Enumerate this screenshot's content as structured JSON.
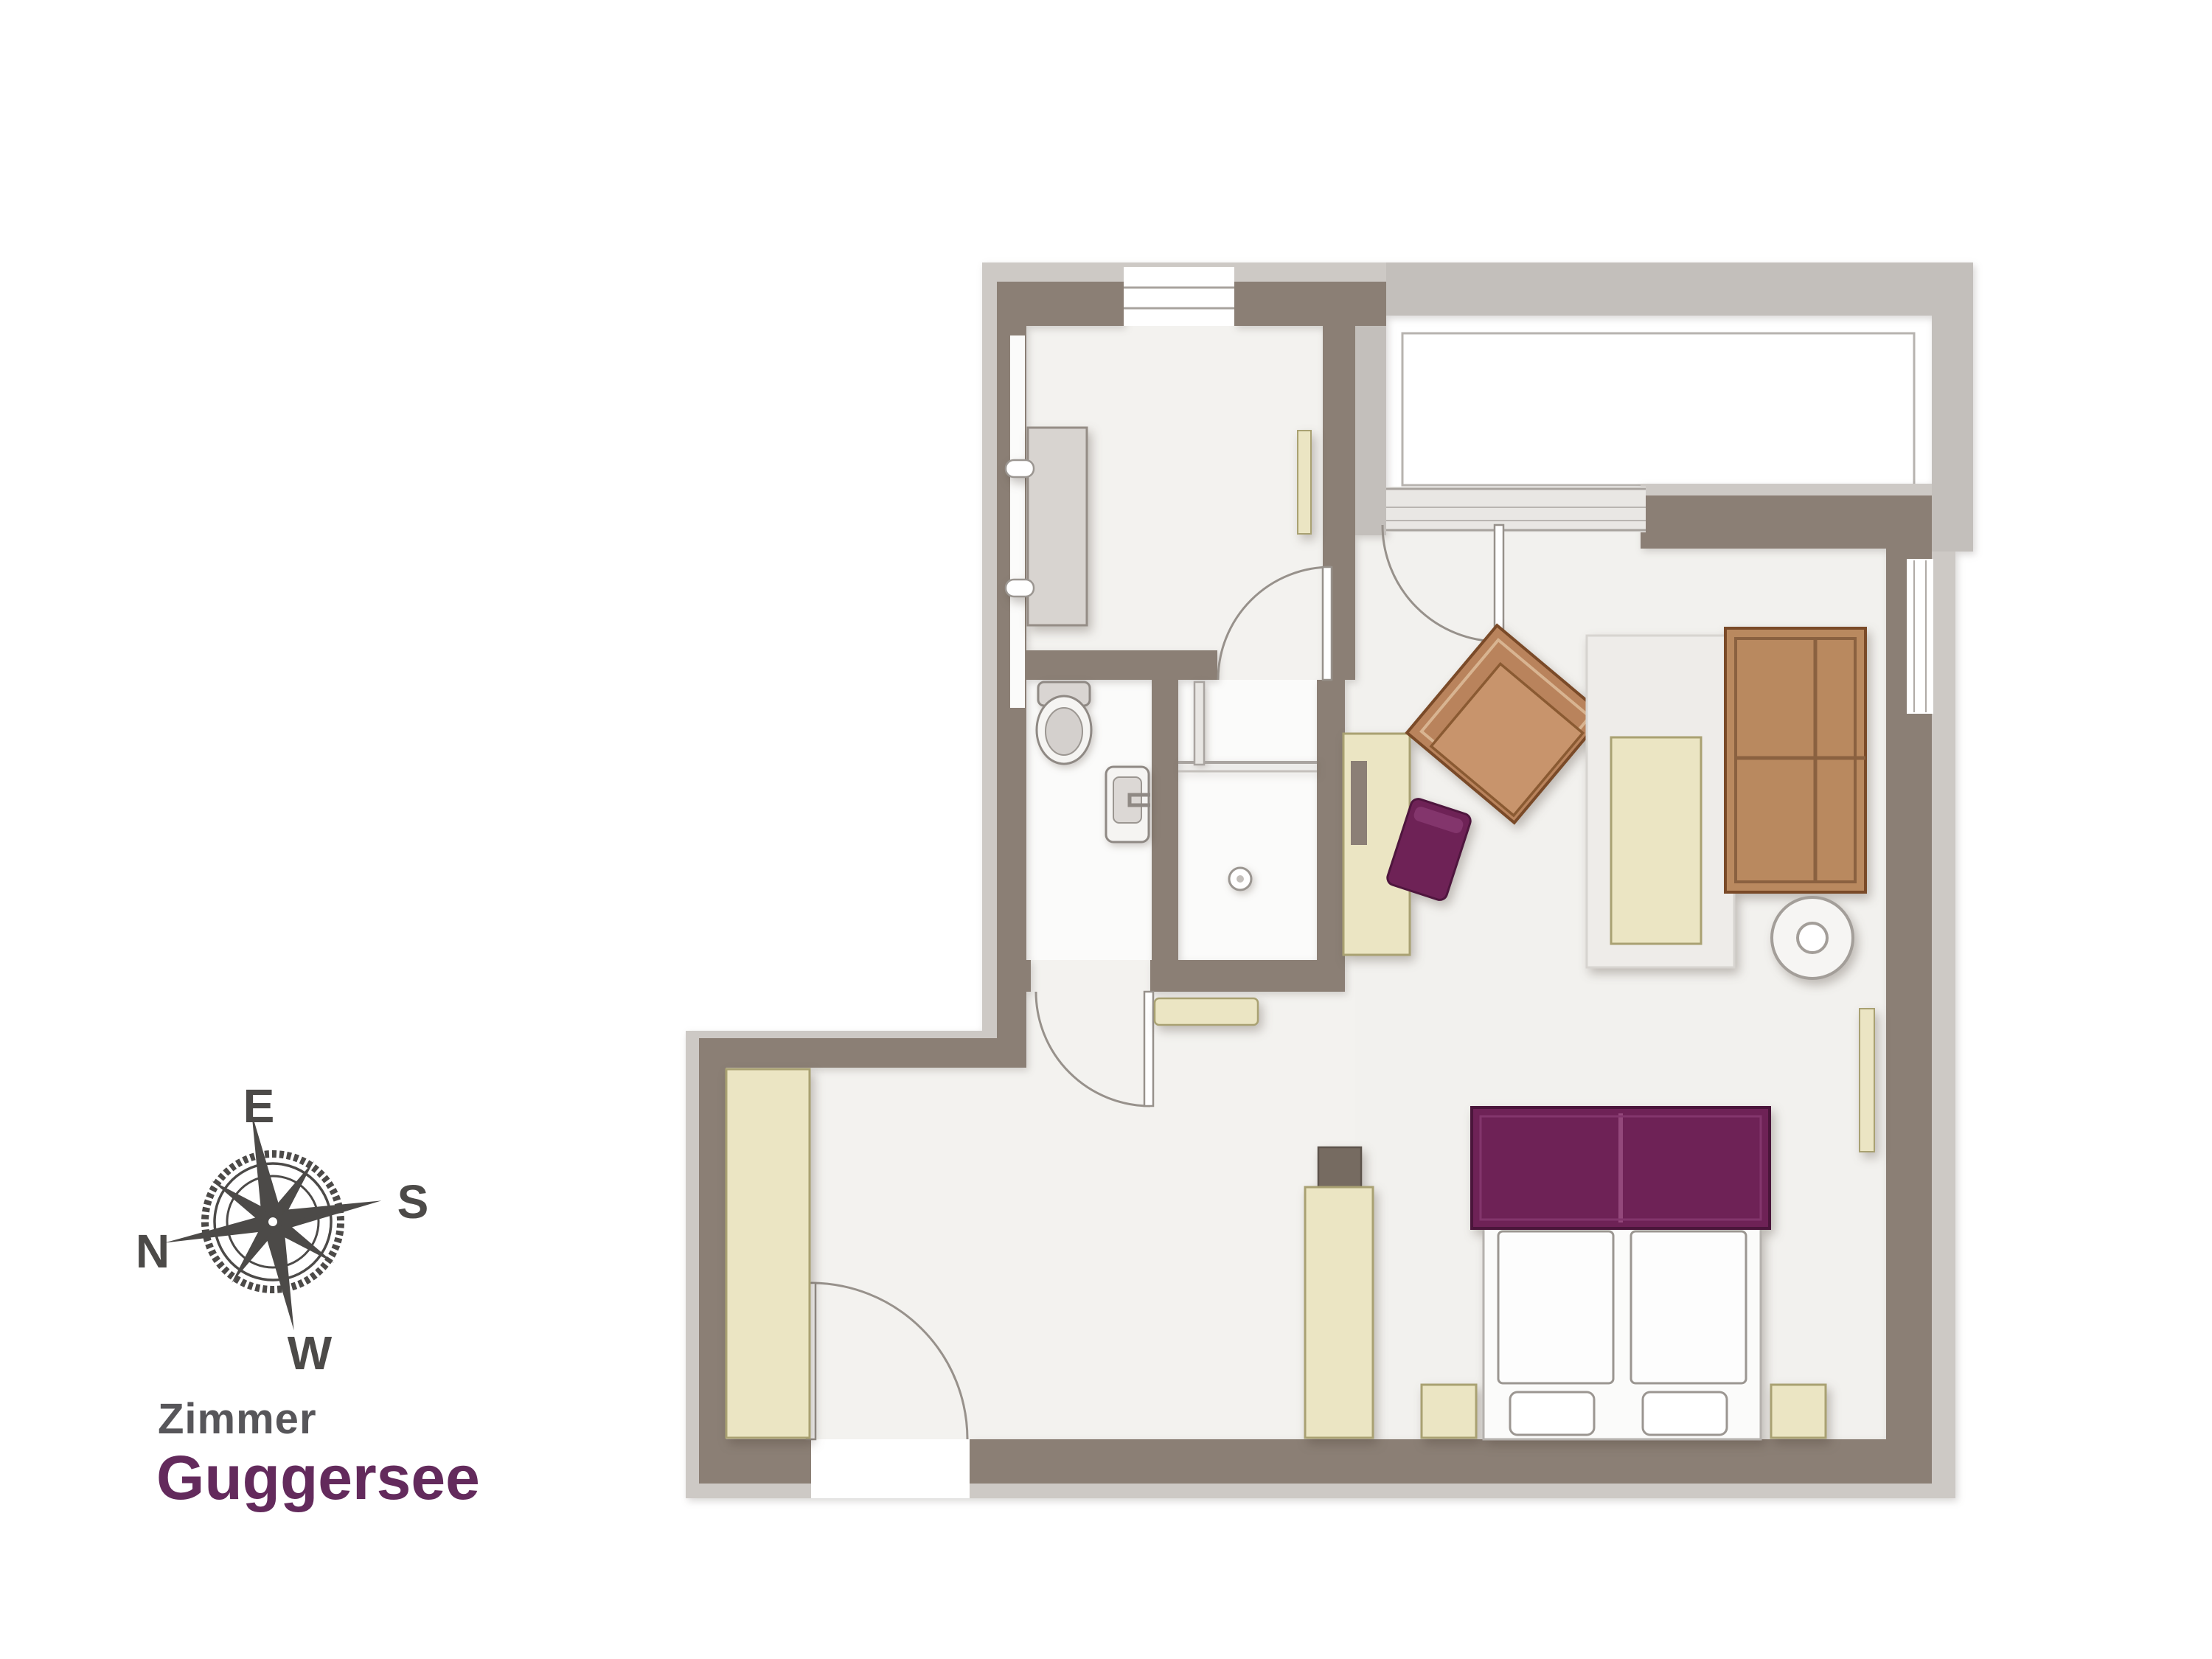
{
  "title": {
    "line1": "Zimmer",
    "line2": "Guggersee"
  },
  "compass": {
    "labels": {
      "top": "E",
      "right": "S",
      "left": "N",
      "bottom": "W"
    },
    "rotation_deg": -11
  },
  "colors": {
    "wall_dark": "#8b7f75",
    "wall_light_edge": "#cdc9c5",
    "balcony_wall": "#c3bfbb",
    "floor": "#f3f2ef",
    "bath_floor": "#fbfbfa",
    "furniture_beige": "#ebe5c3",
    "furniture_beige_border": "#a9a172",
    "wood_brown": "#bd8c63",
    "wood_brown_border": "#7a4a28",
    "accent_purple": "#6e2256",
    "title_purple": "#632a5c",
    "title_gray": "#57565a",
    "rug_gray": "#eeece9",
    "cabinet_gray": "#d8d4d0",
    "door_line": "#97918b"
  },
  "floorplan": {
    "rooms": [
      "entry-closet-room",
      "wc",
      "shower",
      "hallway",
      "corridor",
      "living-sleeping-room",
      "balcony"
    ],
    "furniture": [
      "closet-cabinet",
      "wall-mirror",
      "toilet",
      "sink",
      "shower-glass",
      "bench",
      "entry-wardrobe",
      "minibar-unit",
      "desk",
      "desk-chair",
      "armchair",
      "rug",
      "coffee-table",
      "sofa",
      "side-table",
      "radiator",
      "double-bed",
      "headboard",
      "pillows",
      "nightstands"
    ]
  }
}
